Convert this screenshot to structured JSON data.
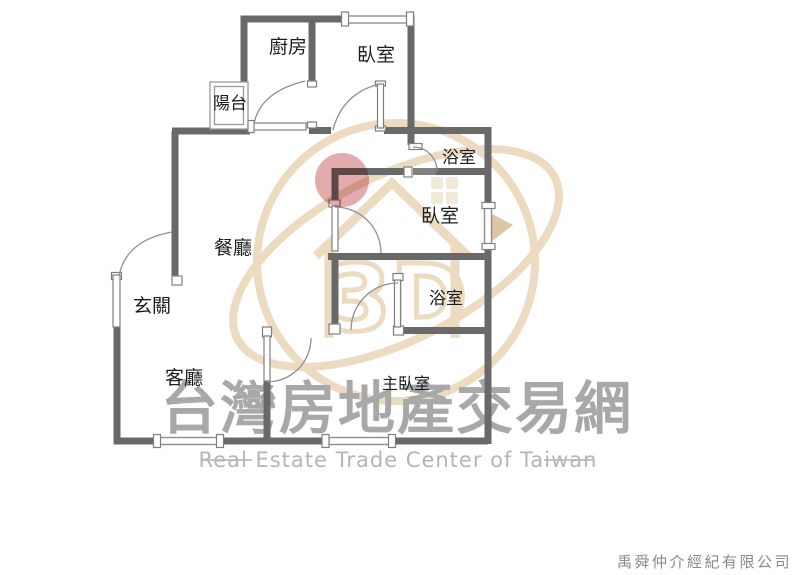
{
  "page": {
    "background": "#ffffff"
  },
  "floorplan": {
    "wall_color": "#696969",
    "highlight_color": "#dfa3a3",
    "rooms": [
      {
        "id": "balcony",
        "label": "陽台"
      },
      {
        "id": "kitchen",
        "label": "廚房"
      },
      {
        "id": "bedroom-top",
        "label": "臥室"
      },
      {
        "id": "bathroom-upper",
        "label": "浴室"
      },
      {
        "id": "bedroom-middle",
        "label": "臥室"
      },
      {
        "id": "dining",
        "label": "餐廳"
      },
      {
        "id": "entry",
        "label": "玄關"
      },
      {
        "id": "bathroom-lower",
        "label": "浴室"
      },
      {
        "id": "living",
        "label": "客廳"
      },
      {
        "id": "master-bedroom",
        "label": "主臥室"
      }
    ]
  },
  "watermark": {
    "title": "台灣房地產交易網",
    "subtitle": "Real Estate Trade Center of Taiwan",
    "logo_text": "3D",
    "title_color": "#a8a8a8",
    "subtitle_color": "#b5b5b5",
    "logo_color": "#ecd9be"
  },
  "footer": {
    "company": "禹舜仲介經紀有限公司",
    "color": "#8a8a8a"
  }
}
